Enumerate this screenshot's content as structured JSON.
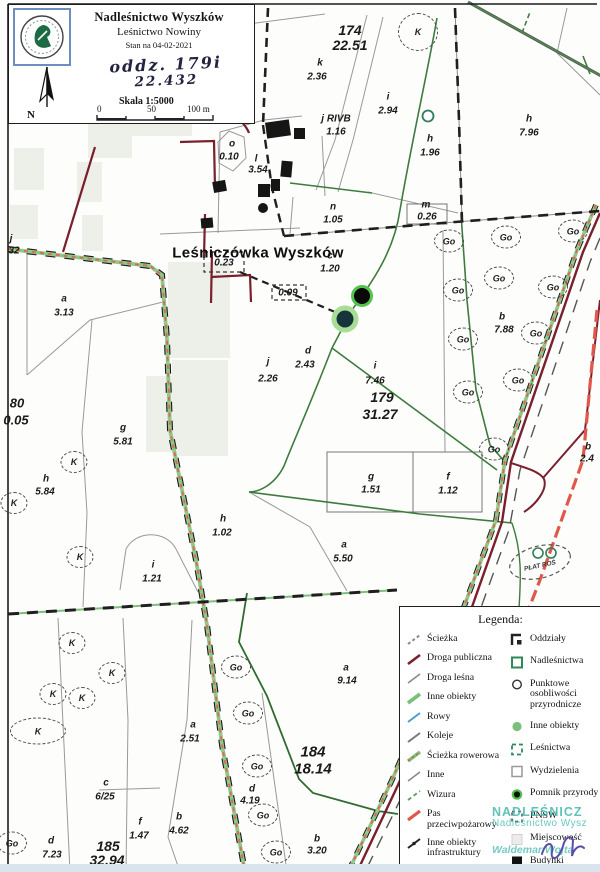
{
  "header": {
    "org": "Nadleśnictwo Wyszków",
    "unit": "Leśnictwo Nowiny",
    "status": "Stan na 04-02-2021",
    "note_line1": "oddz. 179i",
    "note_line2": "22.432",
    "scale": "Skala 1:5000",
    "scalebar": {
      "t0": "0",
      "t1": "50",
      "t2": "100 m"
    },
    "north": "N",
    "logo": "lasy-panstwowe-logo"
  },
  "map": {
    "place": "Leśniczówka Wyszków",
    "plant_patch": "PŁAT ROŚ",
    "go": "Go",
    "k": "K",
    "labels": [
      {
        "t": "174",
        "x": 350,
        "y": 30,
        "s": 14
      },
      {
        "t": "22.51",
        "x": 350,
        "y": 45,
        "s": 14
      },
      {
        "t": "k",
        "x": 320,
        "y": 63
      },
      {
        "t": "2.36",
        "x": 317,
        "y": 77
      },
      {
        "t": "j RIVB",
        "x": 336,
        "y": 119
      },
      {
        "t": "1.16",
        "x": 336,
        "y": 132
      },
      {
        "t": "i",
        "x": 388,
        "y": 97
      },
      {
        "t": "2.94",
        "x": 388,
        "y": 111
      },
      {
        "t": "h",
        "x": 430,
        "y": 139
      },
      {
        "t": "1.96",
        "x": 430,
        "y": 153
      },
      {
        "t": "h",
        "x": 529,
        "y": 119
      },
      {
        "t": "7.96",
        "x": 529,
        "y": 133
      },
      {
        "t": "o",
        "x": 232,
        "y": 144
      },
      {
        "t": "0.10",
        "x": 229,
        "y": 157
      },
      {
        "t": "l",
        "x": 256,
        "y": 159
      },
      {
        "t": "3.54",
        "x": 258,
        "y": 170
      },
      {
        "t": "n",
        "x": 333,
        "y": 207
      },
      {
        "t": "1.05",
        "x": 333,
        "y": 220
      },
      {
        "t": "m",
        "x": 426,
        "y": 205
      },
      {
        "t": "0.26",
        "x": 427,
        "y": 217
      },
      {
        "t": "0.23",
        "x": 224,
        "y": 263
      },
      {
        "t": "c",
        "x": 330,
        "y": 256
      },
      {
        "t": "1.20",
        "x": 330,
        "y": 269
      },
      {
        "t": "0.09",
        "x": 288,
        "y": 293
      },
      {
        "t": "j",
        "x": 11,
        "y": 239
      },
      {
        "t": "32",
        "x": 14,
        "y": 251
      },
      {
        "t": "a",
        "x": 64,
        "y": 299
      },
      {
        "t": "3.13",
        "x": 64,
        "y": 313
      },
      {
        "t": "80",
        "x": 17,
        "y": 403,
        "s": 13
      },
      {
        "t": "0.05",
        "x": 16,
        "y": 420,
        "s": 13
      },
      {
        "t": "d",
        "x": 308,
        "y": 351
      },
      {
        "t": "2.43",
        "x": 305,
        "y": 365
      },
      {
        "t": "j",
        "x": 268,
        "y": 362
      },
      {
        "t": "2.26",
        "x": 268,
        "y": 379
      },
      {
        "t": "i",
        "x": 375,
        "y": 366
      },
      {
        "t": "7.46",
        "x": 375,
        "y": 381
      },
      {
        "t": "179",
        "x": 382,
        "y": 397,
        "s": 14
      },
      {
        "t": "31.27",
        "x": 380,
        "y": 414,
        "s": 14
      },
      {
        "t": "g",
        "x": 123,
        "y": 428
      },
      {
        "t": "5.81",
        "x": 123,
        "y": 442
      },
      {
        "t": "h",
        "x": 46,
        "y": 479
      },
      {
        "t": "5.84",
        "x": 45,
        "y": 492
      },
      {
        "t": "b",
        "x": 502,
        "y": 317
      },
      {
        "t": "7.88",
        "x": 504,
        "y": 330
      },
      {
        "t": "g",
        "x": 371,
        "y": 477
      },
      {
        "t": "1.51",
        "x": 371,
        "y": 490
      },
      {
        "t": "f",
        "x": 448,
        "y": 477
      },
      {
        "t": "1.12",
        "x": 448,
        "y": 491
      },
      {
        "t": "h",
        "x": 223,
        "y": 519
      },
      {
        "t": "1.02",
        "x": 222,
        "y": 533
      },
      {
        "t": "a",
        "x": 344,
        "y": 545
      },
      {
        "t": "5.50",
        "x": 343,
        "y": 559
      },
      {
        "t": "i",
        "x": 153,
        "y": 565
      },
      {
        "t": "1.21",
        "x": 152,
        "y": 579
      },
      {
        "t": "b",
        "x": 588,
        "y": 447
      },
      {
        "t": "2.4",
        "x": 587,
        "y": 459
      },
      {
        "t": "a",
        "x": 193,
        "y": 725
      },
      {
        "t": "2.51",
        "x": 190,
        "y": 739
      },
      {
        "t": "a",
        "x": 346,
        "y": 668
      },
      {
        "t": "9.14",
        "x": 347,
        "y": 681
      },
      {
        "t": "184",
        "x": 313,
        "y": 752,
        "s": 15
      },
      {
        "t": "18.14",
        "x": 313,
        "y": 769,
        "s": 15
      },
      {
        "t": "c",
        "x": 106,
        "y": 783
      },
      {
        "t": "6/25",
        "x": 105,
        "y": 797
      },
      {
        "t": "f",
        "x": 140,
        "y": 822
      },
      {
        "t": "1.47",
        "x": 139,
        "y": 836
      },
      {
        "t": "b",
        "x": 179,
        "y": 817
      },
      {
        "t": "4.62",
        "x": 179,
        "y": 831
      },
      {
        "t": "d",
        "x": 51,
        "y": 841
      },
      {
        "t": "7.23",
        "x": 52,
        "y": 855
      },
      {
        "t": "185",
        "x": 108,
        "y": 846,
        "s": 14
      },
      {
        "t": "32.94",
        "x": 107,
        "y": 860,
        "s": 14
      },
      {
        "t": "d",
        "x": 252,
        "y": 789
      },
      {
        "t": "4.19",
        "x": 250,
        "y": 801
      },
      {
        "t": "b",
        "x": 317,
        "y": 839
      },
      {
        "t": "3.20",
        "x": 317,
        "y": 851
      }
    ],
    "go_positions": [
      [
        449,
        241
      ],
      [
        506,
        237
      ],
      [
        573,
        231
      ],
      [
        458,
        290
      ],
      [
        499,
        278
      ],
      [
        553,
        287
      ],
      [
        536,
        333
      ],
      [
        463,
        339
      ],
      [
        518,
        380
      ],
      [
        468,
        392
      ],
      [
        494,
        449
      ],
      [
        236,
        667
      ],
      [
        248,
        713
      ],
      [
        257,
        766
      ],
      [
        263,
        815
      ],
      [
        276,
        852
      ],
      [
        12,
        843
      ]
    ],
    "k_positions": [
      [
        418,
        32,
        38,
        36
      ],
      [
        74,
        462
      ],
      [
        14,
        503
      ],
      [
        80,
        557
      ],
      [
        72,
        643
      ],
      [
        112,
        673
      ],
      [
        53,
        694
      ],
      [
        82,
        698
      ],
      [
        38,
        731,
        54,
        25
      ]
    ]
  },
  "legend": {
    "title": "Legenda:",
    "left": [
      {
        "icon": "path-dashed",
        "label": "Ścieżka"
      },
      {
        "icon": "road-public",
        "label": "Droga publiczna"
      },
      {
        "icon": "road-forest",
        "label": "Droga leśna"
      },
      {
        "icon": "other-objects-line",
        "label": "Inne obiekty"
      },
      {
        "icon": "ditch",
        "label": "Rowy"
      },
      {
        "icon": "railway",
        "label": "Koleje"
      },
      {
        "icon": "bike-path",
        "label": "Ścieżka rowerowa"
      },
      {
        "icon": "other-line",
        "label": "Inne"
      },
      {
        "icon": "sightline",
        "label": "Wizura"
      },
      {
        "icon": "firebreak",
        "label": "Pas przeciwpożarowy"
      },
      {
        "icon": "infrastructure",
        "label": "Inne obiekty infrastruktury"
      },
      {
        "icon": "division-lines",
        "label": "Linie podziału powierzchniowego"
      }
    ],
    "right": [
      {
        "icon": "compartments",
        "label": "Oddziały"
      },
      {
        "icon": "forest-district",
        "label": "Nadleśnictwa"
      },
      {
        "icon": "nature-points",
        "label": "Punktowe osobliwości przyrodnicze"
      },
      {
        "icon": "other-objects-dot",
        "label": "Inne obiekty"
      },
      {
        "icon": "forestry-unit",
        "label": "Leśnictwa"
      },
      {
        "icon": "subdivisions",
        "label": "Wydzielenia"
      },
      {
        "icon": "nature-monument",
        "label": "Pomnik przyrody"
      },
      {
        "icon": "pnsw",
        "label": "PNSW"
      },
      {
        "icon": "locality",
        "label": "Miejscowość"
      },
      {
        "icon": "buildings",
        "label": "Budynki"
      }
    ]
  },
  "stamp": {
    "line1": "NADLEŚNICZ",
    "line2": "Nadleśnictwo Wysz",
    "line3": "Waldemar Wojta"
  },
  "colors": {
    "road_public": "#7a1f2c",
    "firebreak": "#e0584a",
    "bike_green": "#8cc98c",
    "bike_orange": "#e2654d",
    "road_green": "#3e7c3e",
    "monument_ring": "#54c44e",
    "legend_green": "#2e8b57",
    "ditch_blue": "#4f9bd1",
    "stamp_teal": "#45b8b0",
    "signature_ink": "#5b4ea8"
  }
}
